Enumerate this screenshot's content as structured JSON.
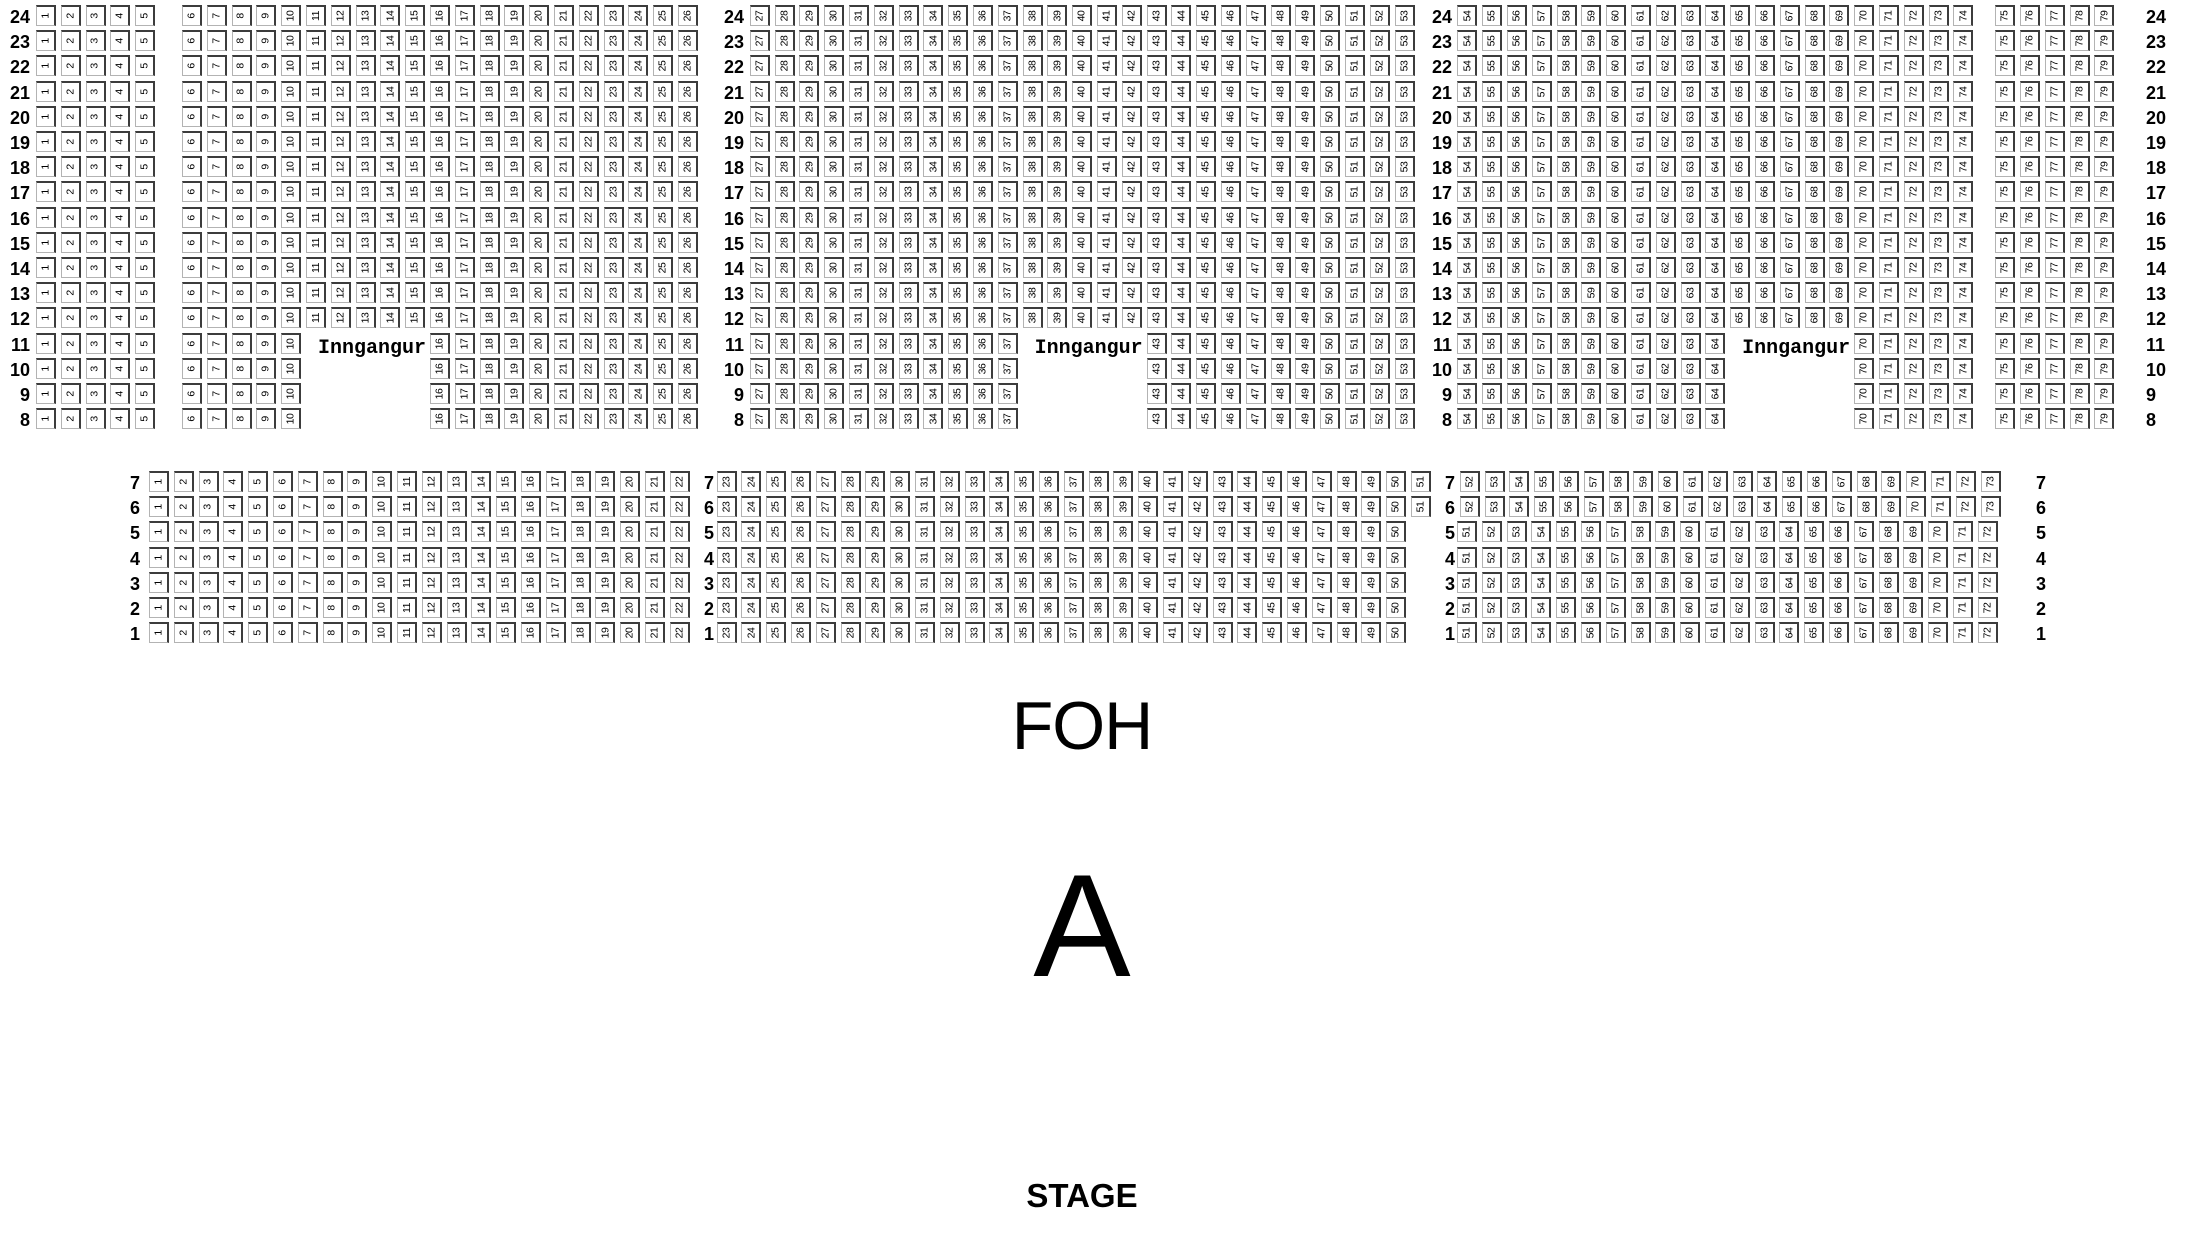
{
  "labels": {
    "foh": "FOH",
    "section": "A",
    "stage": "STAGE"
  },
  "entrances": [
    {
      "label": "Inngangur",
      "location": "left-aisle"
    },
    {
      "label": "Inngangur",
      "location": "center-aisle"
    },
    {
      "label": "Inngangur",
      "location": "right-aisle"
    }
  ],
  "colors": {
    "background": "#ffffff",
    "text": "#000000",
    "seat_border_light": "#b3b3b3",
    "seat_border_dark": "#3c3c3c"
  },
  "upper_section": {
    "rows": [
      {
        "row": 24,
        "segments": [
          [
            1,
            5
          ],
          [
            6,
            26
          ],
          [
            27,
            53
          ],
          [
            54,
            74
          ],
          [
            75,
            79
          ]
        ]
      },
      {
        "row": 23,
        "segments": [
          [
            1,
            5
          ],
          [
            6,
            26
          ],
          [
            27,
            53
          ],
          [
            54,
            74
          ],
          [
            75,
            79
          ]
        ]
      },
      {
        "row": 22,
        "segments": [
          [
            1,
            5
          ],
          [
            6,
            26
          ],
          [
            27,
            53
          ],
          [
            54,
            74
          ],
          [
            75,
            79
          ]
        ]
      },
      {
        "row": 21,
        "segments": [
          [
            1,
            5
          ],
          [
            6,
            26
          ],
          [
            27,
            53
          ],
          [
            54,
            74
          ],
          [
            75,
            79
          ]
        ]
      },
      {
        "row": 20,
        "segments": [
          [
            1,
            5
          ],
          [
            6,
            26
          ],
          [
            27,
            53
          ],
          [
            54,
            74
          ],
          [
            75,
            79
          ]
        ]
      },
      {
        "row": 19,
        "segments": [
          [
            1,
            5
          ],
          [
            6,
            26
          ],
          [
            27,
            53
          ],
          [
            54,
            74
          ],
          [
            75,
            79
          ]
        ]
      },
      {
        "row": 18,
        "segments": [
          [
            1,
            5
          ],
          [
            6,
            26
          ],
          [
            27,
            53
          ],
          [
            54,
            74
          ],
          [
            75,
            79
          ]
        ]
      },
      {
        "row": 17,
        "segments": [
          [
            1,
            5
          ],
          [
            6,
            26
          ],
          [
            27,
            53
          ],
          [
            54,
            74
          ],
          [
            75,
            79
          ]
        ]
      },
      {
        "row": 16,
        "segments": [
          [
            1,
            5
          ],
          [
            6,
            26
          ],
          [
            27,
            53
          ],
          [
            54,
            74
          ],
          [
            75,
            79
          ]
        ]
      },
      {
        "row": 15,
        "segments": [
          [
            1,
            5
          ],
          [
            6,
            26
          ],
          [
            27,
            53
          ],
          [
            54,
            74
          ],
          [
            75,
            79
          ]
        ]
      },
      {
        "row": 14,
        "segments": [
          [
            1,
            5
          ],
          [
            6,
            26
          ],
          [
            27,
            53
          ],
          [
            54,
            74
          ],
          [
            75,
            79
          ]
        ]
      },
      {
        "row": 13,
        "segments": [
          [
            1,
            5
          ],
          [
            6,
            26
          ],
          [
            27,
            53
          ],
          [
            54,
            74
          ],
          [
            75,
            79
          ]
        ]
      },
      {
        "row": 12,
        "segments": [
          [
            1,
            5
          ],
          [
            6,
            26
          ],
          [
            27,
            53
          ],
          [
            54,
            74
          ],
          [
            75,
            79
          ]
        ]
      },
      {
        "row": 11,
        "segments": [
          [
            1,
            5
          ],
          [
            6,
            10
          ],
          [
            16,
            26
          ],
          [
            27,
            37
          ],
          [
            43,
            53
          ],
          [
            54,
            64
          ],
          [
            70,
            74
          ],
          [
            75,
            79
          ]
        ]
      },
      {
        "row": 10,
        "segments": [
          [
            1,
            5
          ],
          [
            6,
            10
          ],
          [
            16,
            26
          ],
          [
            27,
            37
          ],
          [
            43,
            53
          ],
          [
            54,
            64
          ],
          [
            70,
            74
          ],
          [
            75,
            79
          ]
        ]
      },
      {
        "row": 9,
        "segments": [
          [
            1,
            5
          ],
          [
            6,
            10
          ],
          [
            16,
            26
          ],
          [
            27,
            37
          ],
          [
            43,
            53
          ],
          [
            54,
            64
          ],
          [
            70,
            74
          ],
          [
            75,
            79
          ]
        ]
      },
      {
        "row": 8,
        "segments": [
          [
            1,
            5
          ],
          [
            6,
            10
          ],
          [
            16,
            26
          ],
          [
            27,
            37
          ],
          [
            43,
            53
          ],
          [
            54,
            64
          ],
          [
            70,
            74
          ],
          [
            75,
            79
          ]
        ]
      }
    ]
  },
  "lower_section": {
    "rows": [
      {
        "row": 7,
        "segments": [
          [
            1,
            22
          ],
          [
            23,
            51
          ],
          [
            52,
            73
          ]
        ]
      },
      {
        "row": 6,
        "segments": [
          [
            1,
            22
          ],
          [
            23,
            51
          ],
          [
            52,
            73
          ]
        ]
      },
      {
        "row": 5,
        "segments": [
          [
            1,
            22
          ],
          [
            23,
            50
          ],
          [
            51,
            72
          ]
        ]
      },
      {
        "row": 4,
        "segments": [
          [
            1,
            22
          ],
          [
            23,
            50
          ],
          [
            51,
            72
          ]
        ]
      },
      {
        "row": 3,
        "segments": [
          [
            1,
            22
          ],
          [
            23,
            50
          ],
          [
            51,
            72
          ]
        ]
      },
      {
        "row": 2,
        "segments": [
          [
            1,
            22
          ],
          [
            23,
            50
          ],
          [
            51,
            72
          ]
        ]
      },
      {
        "row": 1,
        "segments": [
          [
            1,
            22
          ],
          [
            23,
            50
          ],
          [
            51,
            72
          ]
        ]
      }
    ]
  }
}
